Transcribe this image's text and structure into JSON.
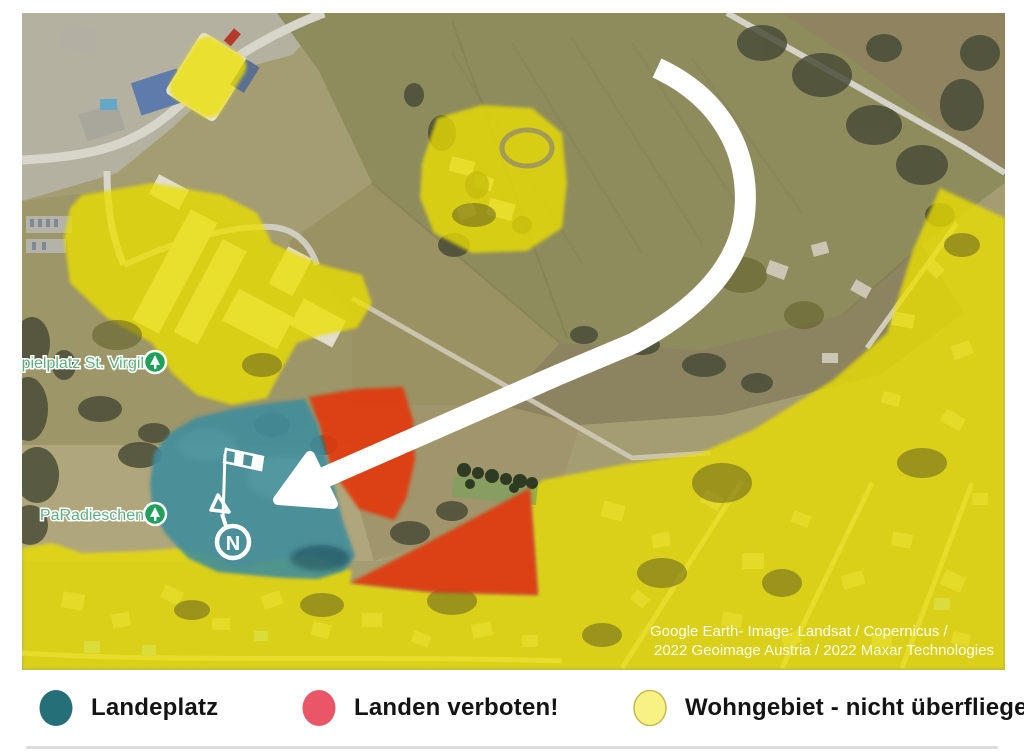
{
  "map": {
    "labels": {
      "playground": "Spielplatz St. Virgil",
      "paradieschen": "PaRadieschen"
    },
    "north_label": "N",
    "attribution": {
      "line1": "Google Earth- Image: Landsat / Copernicus /",
      "line2": "2022 Geoimage Austria / 2022 Maxar Technologies"
    },
    "zones": {
      "landing_color": "#418d9b",
      "forbidden_color": "#e03a12",
      "residential_color": "#eadf00"
    },
    "icons": [
      "windsock-icon",
      "north-arrow-icon",
      "park-pin-icon",
      "approach-arrow"
    ]
  },
  "legend": {
    "items": [
      {
        "label": "Landeplatz",
        "color": "#256f78"
      },
      {
        "label": "Landen verboten!",
        "color": "#ea5567"
      },
      {
        "label": "Wohngebiet - nicht überfliegen!",
        "color": "#f8f285"
      }
    ]
  }
}
